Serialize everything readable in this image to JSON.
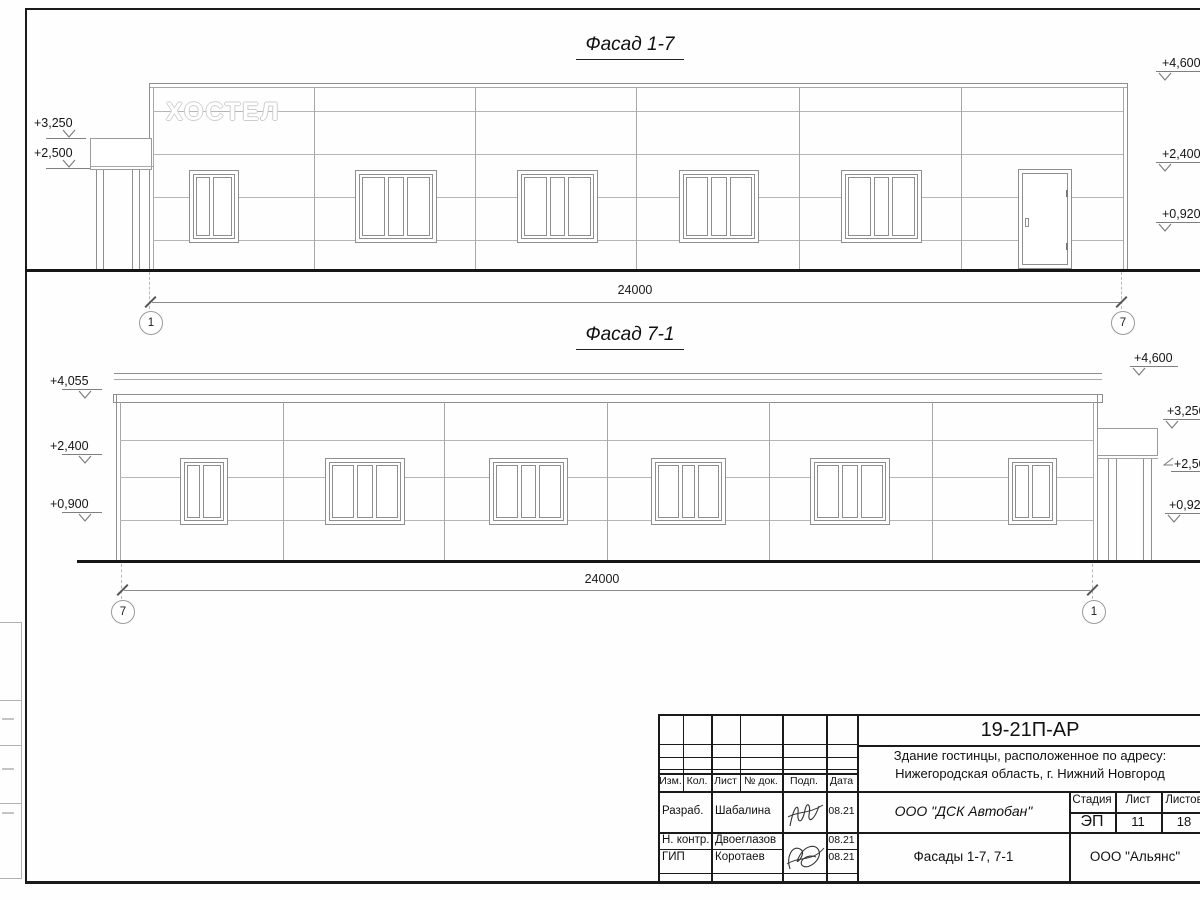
{
  "facade1": {
    "title": "Фасад 1-7",
    "sign": "ХОСТЕЛ",
    "dim": "24000",
    "axis_left": "1",
    "axis_right": "7",
    "elev_left": [
      "+3,250",
      "+2,500"
    ],
    "elev_right": [
      "+4,600",
      "+2,400",
      "+0,920"
    ]
  },
  "facade2": {
    "title": "Фасад 7-1",
    "dim": "24000",
    "axis_left": "7",
    "axis_right": "1",
    "elev_left": [
      "+4,055",
      "+2,400",
      "+0,900"
    ],
    "elev_right": [
      "+4,600",
      "+3,250",
      "+2,500",
      "+0,920"
    ]
  },
  "title_block": {
    "doc_number": "19-21П-АР",
    "project_line1": "Здание гостинцы, расположенное по адресу:",
    "project_line2": "Нижегородская область, г. Нижний Новгород",
    "columns": [
      "Изм.",
      "Кол.",
      "Лист",
      "№ док.",
      "Подп.",
      "Дата"
    ],
    "rows": [
      {
        "role": "Разраб.",
        "name": "Шабалина",
        "date": "08.21"
      },
      {
        "role": "Н. контр.",
        "name": "Двоеглазов",
        "date": "08.21"
      },
      {
        "role": "ГИП",
        "name": "Коротаев",
        "date": "08.21"
      }
    ],
    "company": "ООО \"ДСК Автобан\"",
    "stage_label": "Стадия",
    "sheet_label": "Лист",
    "sheets_label": "Листов",
    "stage": "ЭП",
    "sheet_no": "11",
    "sheets_total": "18",
    "sheet_title": "Фасады 1-7, 7-1",
    "contractor": "ООО \"Альянс\""
  }
}
